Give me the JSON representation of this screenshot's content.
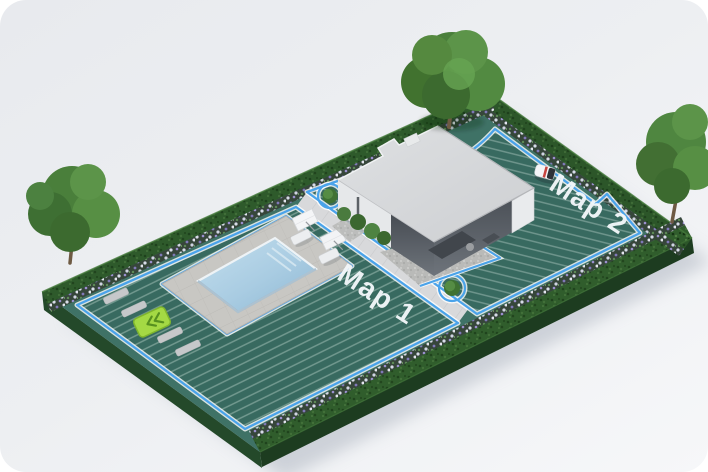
{
  "illustration": {
    "name": "robot-mower-garden-3d-map",
    "zones": [
      {
        "id": "map1",
        "label": "Map 1"
      },
      {
        "id": "map2",
        "label": "Map 2"
      }
    ],
    "boundary_color": "#4aa3ea",
    "label_color": "#f3f7fa",
    "colors": {
      "card_background": "#edeff2",
      "lawn": "#3f7266",
      "lawn_stripe": "#6fa093",
      "hedge": "#2e5a2b",
      "path": "#d8d9db",
      "pool_water": "#a9cce2",
      "house_roof": "#d6d8da",
      "passage_marker": "#a4d944"
    },
    "objects": [
      "house",
      "swimming-pool",
      "pool-deck",
      "sun-loungers",
      "garden-path",
      "hedge-border",
      "flower-beds",
      "large-tree",
      "left-tree",
      "right-tree",
      "round-bushes",
      "robot-mower",
      "passage-marker",
      "stepping-stones"
    ]
  }
}
